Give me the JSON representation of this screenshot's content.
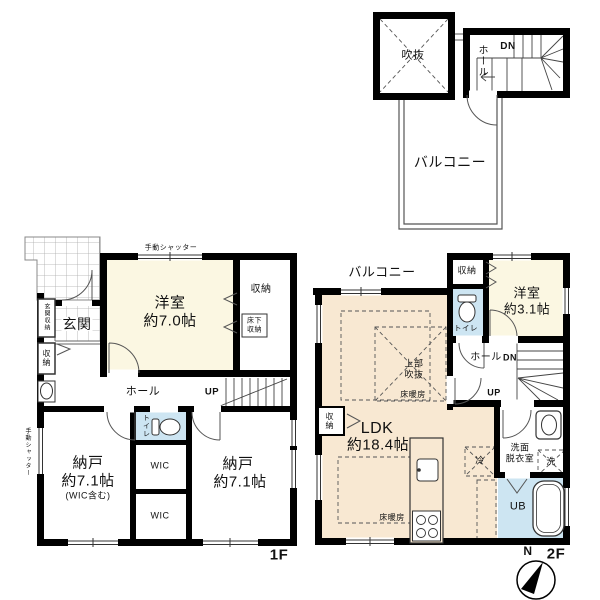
{
  "colors": {
    "wall": "#000000",
    "thin_line": "#444444",
    "room_cream": "#FBF7E2",
    "room_peach": "#F8E8D2",
    "wet_blue": "#CDE5F2",
    "tile_line": "#aaaaaa"
  },
  "roof": {
    "void": "吹抜",
    "hall": "ホール",
    "down": "DN",
    "balcony": "バルコニー"
  },
  "f1": {
    "floor": "1F",
    "shutter_top": "手動シャッター",
    "shutter_left": "手動シャッター",
    "room_name": "洋室",
    "room_size": "約7.0帖",
    "closet_top": "収納",
    "underfloor_1": "床下",
    "underfloor_2": "収納",
    "entrance": "玄関",
    "entrance_closet": "玄関収納",
    "closet_left": "収納",
    "hall": "ホール",
    "up": "UP",
    "toilet": "トイレ",
    "wic_a": "WIC",
    "wic_b": "WIC",
    "storage_l_name": "納戸",
    "storage_l_size": "約7.1帖",
    "storage_l_note": "(WIC含む)",
    "storage_r_name": "納戸",
    "storage_r_size": "約7.1帖"
  },
  "f2": {
    "floor": "2F",
    "balcony": "バルコニー",
    "closet_top": "収納",
    "room_name": "洋室",
    "room_size": "約3.1帖",
    "toilet": "トイレ",
    "hall": "ホール",
    "down": "DN",
    "up": "UP",
    "void_1": "上部",
    "void_2": "吹抜",
    "heating_upper": "床暖房",
    "heating_lower": "床暖房",
    "ldk_name": "LDK",
    "ldk_size": "約18.4帖",
    "closet_left": "収納",
    "fridge": "冷",
    "washroom_1": "洗面",
    "washroom_2": "脱衣室",
    "washer": "洗",
    "bath": "UB",
    "compass_north": "N"
  }
}
